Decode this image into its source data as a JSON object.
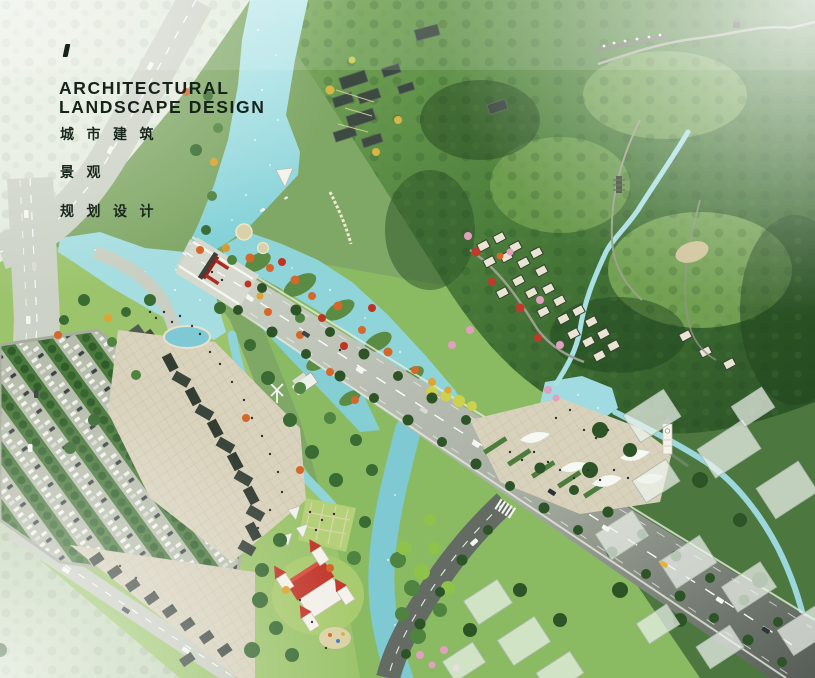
{
  "title_block": {
    "tick_mark": "/",
    "line1": "ARCHITECTURAL",
    "line2": "LANDSCAPE DESIGN",
    "chinese_line1": "城市建筑",
    "chinese_line2": "景观",
    "chinese_line3": "规划设计",
    "text_color": "#16231a"
  },
  "scene": {
    "type": "aerial-masterplan-rendering",
    "colors": {
      "river_water": "#8fd6da",
      "lake_water": "#a5dde0",
      "mountain_forest_dark": "#2a5226",
      "mountain_forest_light": "#7fae5e",
      "park_lawn": "#9cc46c",
      "road_light": "#cdd2c6",
      "road_asphalt": "#5a615a",
      "plaza_paving": "#d9d3bd",
      "castle_roof_red": "#c23a2e",
      "autumn_tree_orange": "#d4682a",
      "autumn_tree_red": "#bf3524",
      "blossom_pink": "#e2a0bf",
      "village_roof_cream": "#e9e5d2",
      "temple_roof_slate": "#3d4a41",
      "massing_building_white": "#edf2ec"
    },
    "features": [
      "river",
      "lake",
      "wetland-islands",
      "mountain-forest",
      "ridge-trail",
      "hilltop-pavilion",
      "waterfall-stream",
      "pagoda",
      "temple-complex",
      "hillside-village",
      "main-avenue",
      "bridge",
      "red-gateway",
      "left-highway",
      "parking-lot",
      "visitor-center",
      "entrance-plaza",
      "fountain-pool",
      "commercial-street",
      "windmill",
      "lawn-garden",
      "castle-playground",
      "east-plaza",
      "canopy-sails",
      "clock-tower",
      "pond",
      "massing-buildings",
      "street-trees",
      "cars",
      "pedestrians",
      "boats"
    ]
  }
}
